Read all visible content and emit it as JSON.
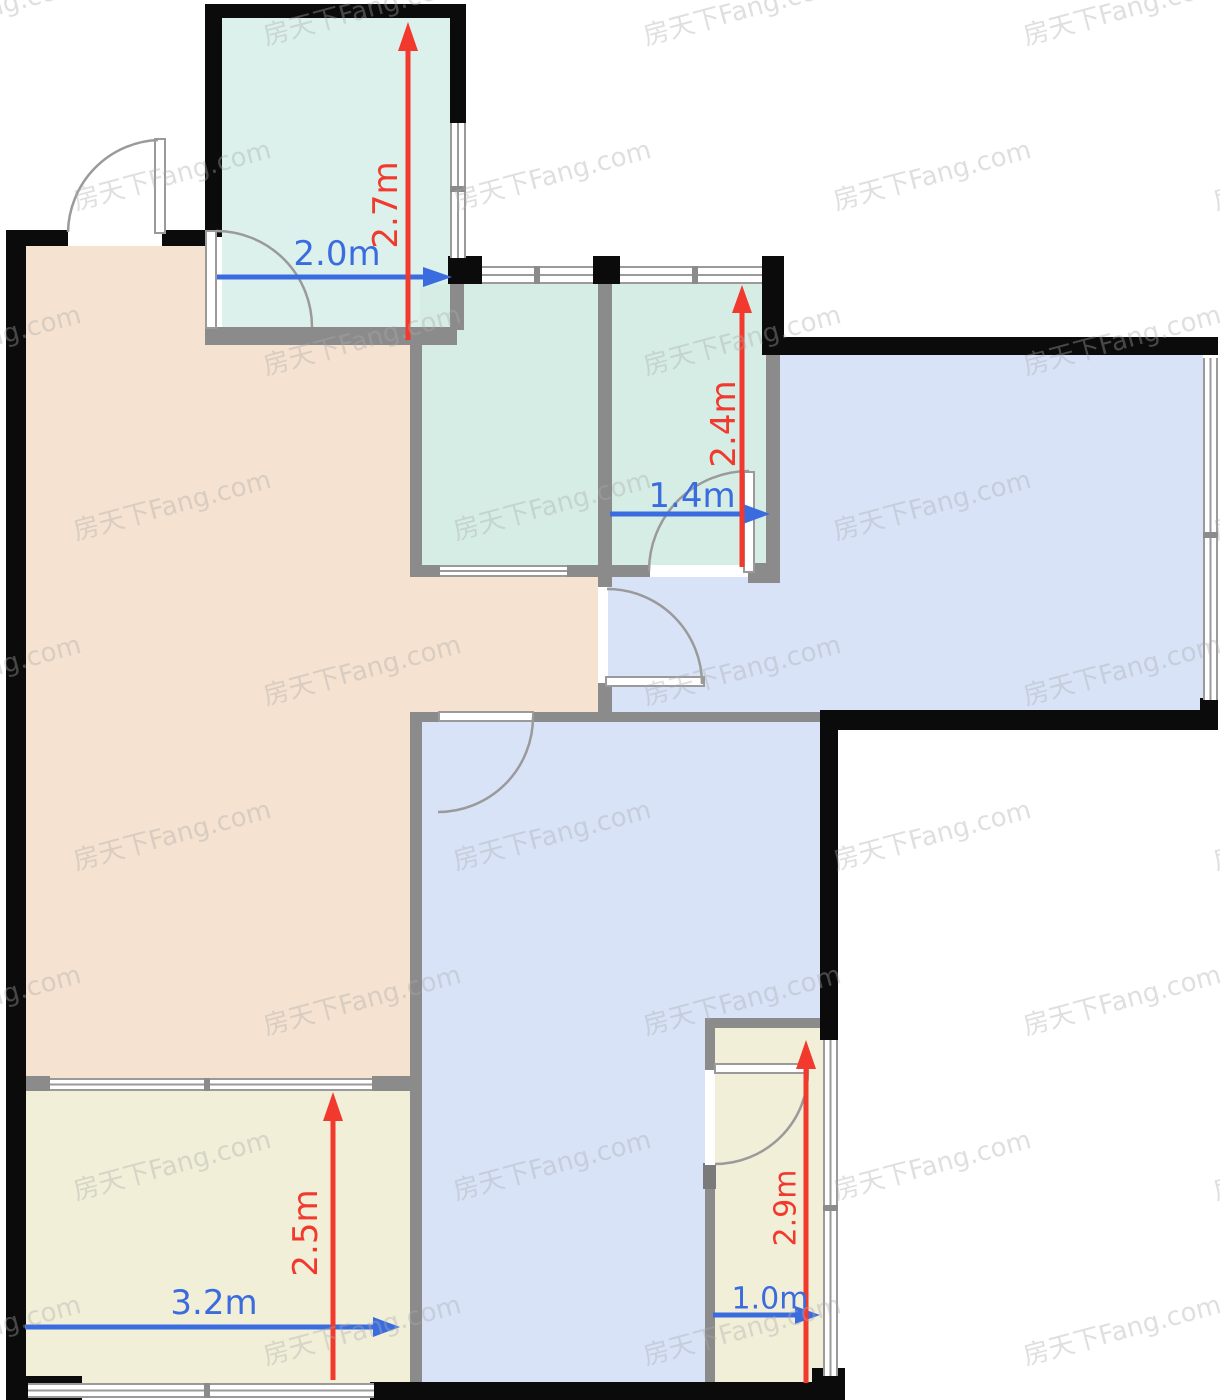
{
  "watermark": {
    "text": "房天下Fang.com"
  },
  "colors": {
    "wall": "#0b0b0b",
    "partition": "#8b8b8b",
    "balcony_fill": "#dcf1eb",
    "teal_fill": "#d6ede6",
    "blue_fill": "#d8e3f8",
    "beige_fill": "#f5e2d0",
    "yellow_fill": "#f1efd8",
    "dim_blue": "#3a6ce0",
    "dim_red": "#f2392d"
  },
  "dimensions": {
    "top_left_room": {
      "width": "2.0m",
      "height": "2.7m"
    },
    "top_middle_room": {
      "width": "1.4m",
      "height": "2.4m"
    },
    "bottom_left_room": {
      "width": "3.2m",
      "height": "2.5m"
    },
    "bottom_right_room": {
      "width": "1.0m",
      "height": "2.9m"
    }
  }
}
